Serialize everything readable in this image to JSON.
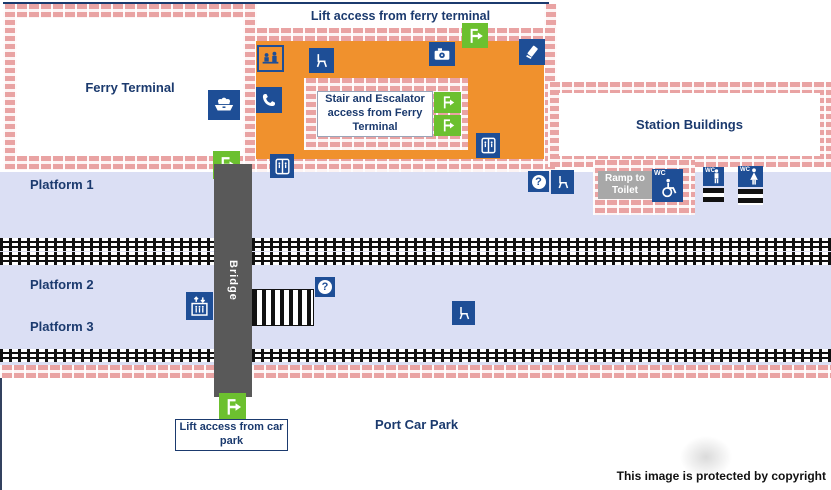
{
  "labels": {
    "lift_ferry_terminal": "Lift access from ferry terminal",
    "ferry_terminal": "Ferry Terminal",
    "station_buildings": "Station Buildings",
    "stair_escalator_access": "Stair and Escalator access from Ferry Terminal",
    "platform_1": "Platform 1",
    "platform_2": "Platform 2",
    "platform_3": "Platform 3",
    "bridge": "Bridge",
    "ramp_to_toilet": "Ramp to Toilet",
    "lift_car_park": "Lift access from car park",
    "port_car_park": "Port Car Park",
    "copyright": "This image is protected by copyright"
  },
  "glyphs": {
    "help": "?",
    "wc": "WC"
  },
  "icons": {
    "ferry-icon": "white ferry on navy square",
    "ticket-office-icon": "staff serving at counter, navy on orange square",
    "waiting-room-icon": "white chair on navy square",
    "telephone-icon": "white handset on navy square",
    "cctv-icon": "white camera on navy square",
    "ticket-machine-icon": "hand with ticket on navy square",
    "lift-icon": "lift car with split doors on navy square",
    "lift-access-icon": "white door with right arrow on green square",
    "platform-lift-icon": "up-down arrows over lift car with people, navy square",
    "help-point-icon": "question mark in white circle on navy square",
    "accessible-toilet-icon": "WC text with wheelchair on navy square",
    "toilet-men-icon": "WC text with male figure on navy square",
    "toilet-women-icon": "WC text with female figure on navy square",
    "stairs-icon": "black and white striped stairs"
  },
  "colors": {
    "concourse_orange": "#f0912d",
    "rail_navy": "#1e4e96",
    "text_navy": "#1b3a6e",
    "access_green": "#6cc02f",
    "platform_blue": "#dbdff4",
    "bridge_gray": "#595959",
    "brick_pink": "#e9a3a3",
    "ramp_label_gray": "#a8a8a8",
    "track_black": "#111111"
  }
}
